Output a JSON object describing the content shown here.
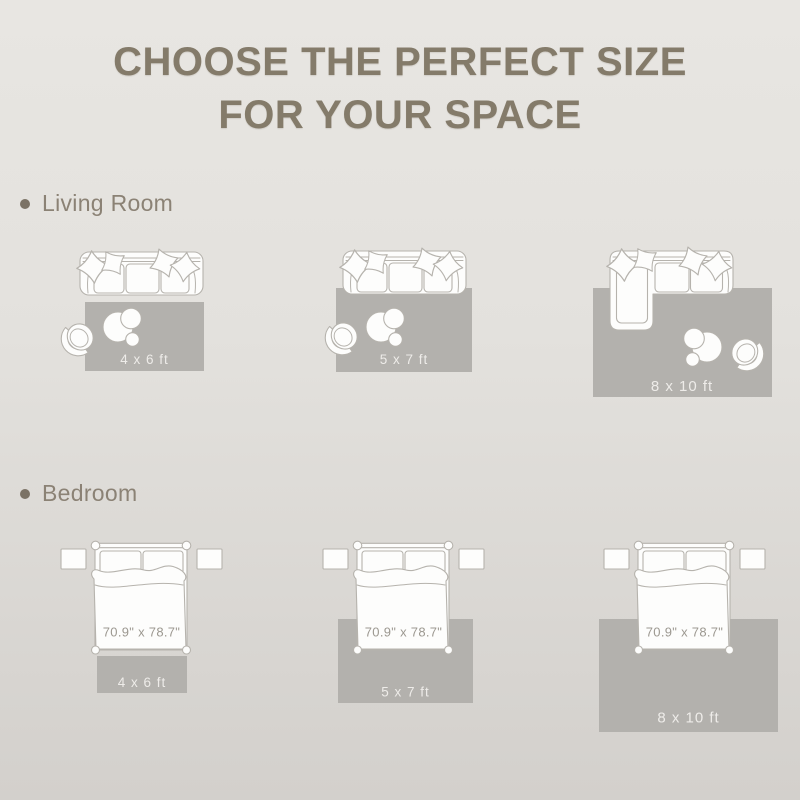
{
  "title": {
    "line1": "CHOOSE THE PERFECT SIZE",
    "line2": "FOR YOUR SPACE"
  },
  "sections": [
    {
      "label": "Living Room",
      "layouts": [
        {
          "rug_size": "4 x 6 ft",
          "illustration": "sofa-armchair-coffee-table-rug"
        },
        {
          "rug_size": "5 x 7 ft",
          "illustration": "sofa-armchair-coffee-table-rug"
        },
        {
          "rug_size": "8 x 10 ft",
          "illustration": "sectional-sofa-armchair-coffee-table-rug"
        }
      ]
    },
    {
      "label": "Bedroom",
      "layouts": [
        {
          "rug_size": "4 x 6 ft",
          "bed_size": "70.9\" x 78.7\"",
          "illustration": "bed-nightstands-rug"
        },
        {
          "rug_size": "5 x 7 ft",
          "bed_size": "70.9\" x 78.7\"",
          "illustration": "bed-nightstands-rug"
        },
        {
          "rug_size": "8 x 10 ft",
          "bed_size": "70.9\" x 78.7\"",
          "illustration": "bed-nightstands-rug"
        }
      ]
    }
  ],
  "colors": {
    "background_top": "#e8e6e2",
    "background_bottom": "#d3d0cc",
    "title_text": "#847b6a",
    "section_label_text": "#8b8275",
    "bullet": "#7b7265",
    "rug_fill": "#b3b1ad",
    "rug_label_text": "#eeece9",
    "furniture_outline": "#b6b3ad",
    "furniture_fill": "#fdfdfc",
    "bed_dimension_text": "#9c9890"
  }
}
